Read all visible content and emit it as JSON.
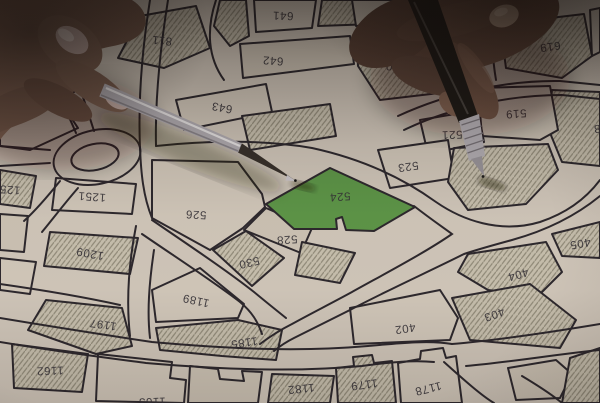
{
  "scene": {
    "description_objects": [
      {
        "name": "cadastral-parcel-map-paper"
      },
      {
        "name": "left-hand-holding-silver-pen"
      },
      {
        "name": "right-hand-holding-black-pen"
      },
      {
        "name": "green-highlighted-parcel"
      }
    ]
  },
  "map": {
    "highlighted_parcel": "524",
    "colors": {
      "paper": "#d6cec2",
      "line": "#29252d",
      "highlight_green": "#5c9a49",
      "hatch_stripe": "#948f7e"
    },
    "parcel_labels": [
      {
        "text": "811",
        "x": 162,
        "y": 40,
        "rot": 186,
        "clipped": false
      },
      {
        "text": "641",
        "x": 283,
        "y": 15,
        "rot": 182,
        "clipped": false
      },
      {
        "text": "642",
        "x": 273,
        "y": 60,
        "rot": 184,
        "clipped": false
      },
      {
        "text": "643",
        "x": 222,
        "y": 107,
        "rot": 190,
        "clipped": false
      },
      {
        "text": "640",
        "x": 396,
        "y": 66,
        "rot": 184,
        "clipped": false
      },
      {
        "text": "619",
        "x": 550,
        "y": 46,
        "rot": 172,
        "clipped": false
      },
      {
        "text": "519",
        "x": 516,
        "y": 113,
        "rot": 176,
        "clipped": false
      },
      {
        "text": "521",
        "x": 452,
        "y": 134,
        "rot": 178,
        "clipped": false
      },
      {
        "text": "523",
        "x": 408,
        "y": 166,
        "rot": 172,
        "clipped": false
      },
      {
        "text": "524",
        "x": 340,
        "y": 196,
        "rot": 176,
        "clipped": false
      },
      {
        "text": "526",
        "x": 196,
        "y": 214,
        "rot": 183,
        "clipped": false
      },
      {
        "text": "528",
        "x": 287,
        "y": 239,
        "rot": 176,
        "clipped": false
      },
      {
        "text": "530",
        "x": 249,
        "y": 262,
        "rot": 167,
        "clipped": false
      },
      {
        "text": "125",
        "x": 10,
        "y": 189,
        "rot": 184,
        "clipped": true
      },
      {
        "text": "1251",
        "x": 92,
        "y": 196,
        "rot": 184,
        "clipped": false
      },
      {
        "text": "1209",
        "x": 90,
        "y": 253,
        "rot": 190,
        "clipped": false
      },
      {
        "text": "1197",
        "x": 103,
        "y": 324,
        "rot": 188,
        "clipped": false
      },
      {
        "text": "1189",
        "x": 196,
        "y": 300,
        "rot": 192,
        "clipped": false
      },
      {
        "text": "1185",
        "x": 244,
        "y": 342,
        "rot": 172,
        "clipped": false
      },
      {
        "text": "1162",
        "x": 50,
        "y": 370,
        "rot": 178,
        "clipped": false
      },
      {
        "text": "1163",
        "x": 152,
        "y": 401,
        "rot": 178,
        "clipped": true
      },
      {
        "text": "1182",
        "x": 301,
        "y": 388,
        "rot": 174,
        "clipped": false
      },
      {
        "text": "1179",
        "x": 364,
        "y": 384,
        "rot": 172,
        "clipped": false
      },
      {
        "text": "1178",
        "x": 428,
        "y": 388,
        "rot": 166,
        "clipped": false
      },
      {
        "text": "402",
        "x": 405,
        "y": 328,
        "rot": 172,
        "clipped": false
      },
      {
        "text": "403",
        "x": 494,
        "y": 314,
        "rot": 160,
        "clipped": false
      },
      {
        "text": "404",
        "x": 518,
        "y": 274,
        "rot": 164,
        "clipped": false
      },
      {
        "text": "405",
        "x": 580,
        "y": 243,
        "rot": 170,
        "clipped": false
      },
      {
        "text": "8",
        "x": 597,
        "y": 128,
        "rot": 176,
        "clipped": true
      }
    ]
  }
}
